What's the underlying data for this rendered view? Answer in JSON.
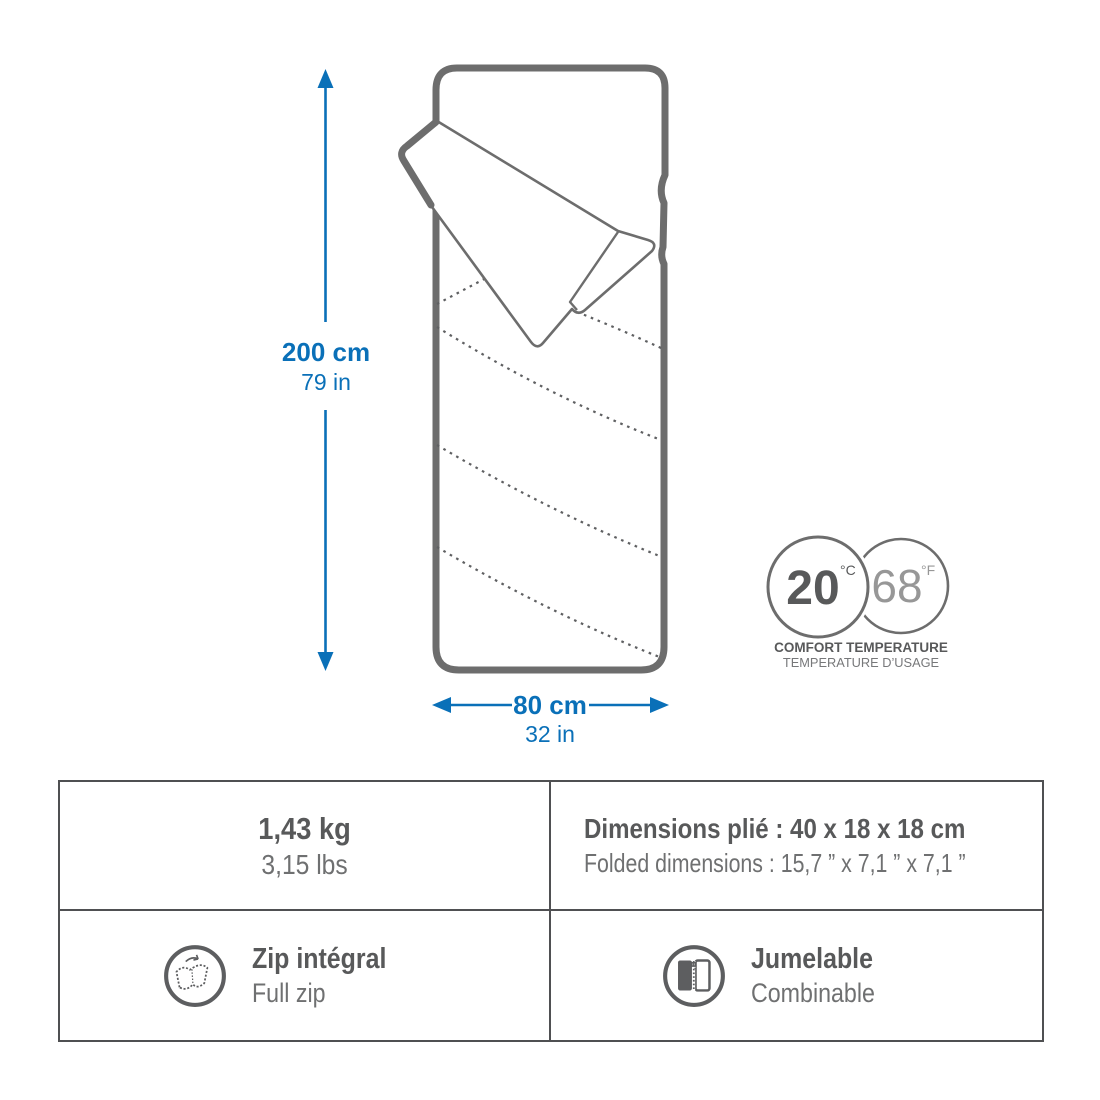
{
  "colors": {
    "accent_blue": "#0a70b8",
    "outline_gray": "#6d6d6d",
    "table_border_gray": "#4f5052",
    "text_dark": "#58595a",
    "text_mid": "#6f7071"
  },
  "size_diagram": {
    "height_label": {
      "metric": "200 cm",
      "imperial": "79 in"
    },
    "width_label": {
      "metric": "80 cm",
      "imperial": "32 in"
    }
  },
  "temperature_badge": {
    "celsius_value": "20",
    "celsius_unit": "°C",
    "fahrenheit_value": "68",
    "fahrenheit_unit": "°F",
    "caption_primary": "COMFORT TEMPERATURE",
    "caption_secondary": "TEMPERATURE D’USAGE"
  },
  "spec_table": {
    "weight": {
      "primary": "1,43 kg",
      "secondary": "3,15 lbs"
    },
    "folded_dimensions": {
      "primary": "Dimensions plié : 40 x 18 x 18 cm",
      "secondary": "Folded dimensions : 15,7 ” x 7,1 ” x 7,1 ”"
    },
    "full_zip": {
      "primary": "Zip intégral",
      "secondary": "Full zip"
    },
    "pairing": {
      "primary": "Jumelable",
      "secondary": "Combinable"
    }
  }
}
